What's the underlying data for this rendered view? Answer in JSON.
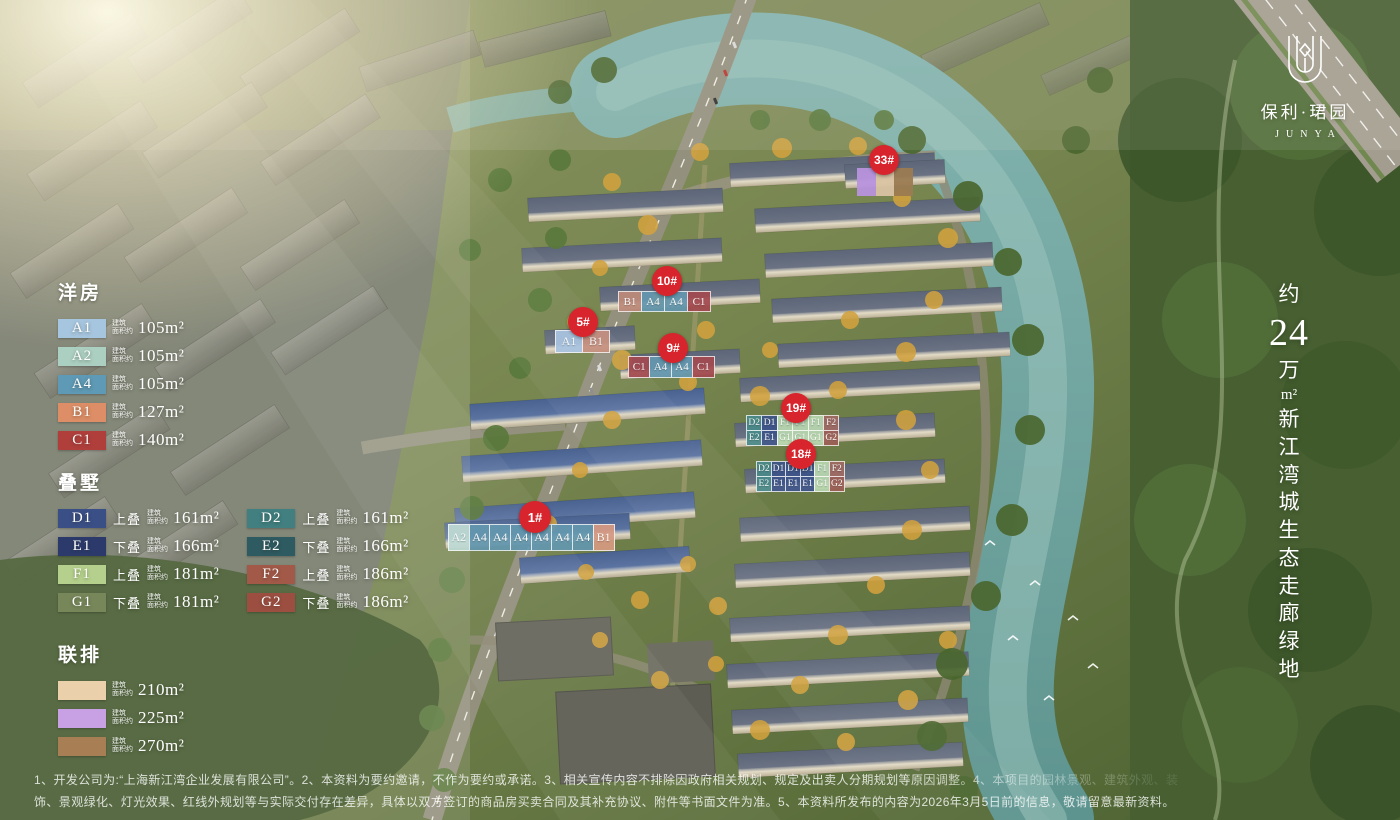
{
  "brand": {
    "name": "保利·珺园",
    "latin": "JUNYA"
  },
  "eco_tagline": {
    "about": "约",
    "number": "24",
    "wan": "万",
    "sqm": "m²",
    "chars": [
      "新",
      "江",
      "湾",
      "城",
      "生",
      "态",
      "走",
      "廊",
      "绿",
      "地"
    ]
  },
  "ui": {
    "badge_color": "#d7242d"
  },
  "legend": {
    "area_prefix": [
      "建筑",
      "面积约"
    ],
    "yangfang": {
      "title": "洋房",
      "rows": [
        {
          "code": "A1",
          "color": "#a6c5de",
          "tier": "",
          "area": "105m²"
        },
        {
          "code": "A2",
          "color": "#abcfc1",
          "tier": "",
          "area": "105m²"
        },
        {
          "code": "A4",
          "color": "#5e99b5",
          "tier": "",
          "area": "105m²"
        },
        {
          "code": "B1",
          "color": "#dd8e66",
          "tier": "",
          "area": "127m²"
        },
        {
          "code": "C1",
          "color": "#b03f3c",
          "tier": "",
          "area": "140m²"
        }
      ]
    },
    "dieshu": {
      "title": "叠墅",
      "col1": [
        {
          "code": "D1",
          "color": "#3a4f86",
          "tier": "上叠",
          "area": "161m²"
        },
        {
          "code": "E1",
          "color": "#2b3a6b",
          "tier": "下叠",
          "area": "166m²"
        },
        {
          "code": "F1",
          "color": "#b5d08c",
          "tier": "上叠",
          "area": "181m²"
        },
        {
          "code": "G1",
          "color": "#77875a",
          "tier": "下叠",
          "area": "181m²"
        }
      ],
      "col2": [
        {
          "code": "D2",
          "color": "#417f80",
          "tier": "上叠",
          "area": "161m²"
        },
        {
          "code": "E2",
          "color": "#2e5a61",
          "tier": "下叠",
          "area": "166m²"
        },
        {
          "code": "F2",
          "color": "#a25948",
          "tier": "上叠",
          "area": "186m²"
        },
        {
          "code": "G2",
          "color": "#9c4f41",
          "tier": "下叠",
          "area": "186m²"
        }
      ]
    },
    "lianpai": {
      "title": "联排",
      "rows": [
        {
          "code": "",
          "color": "#ead0ab",
          "tier": "",
          "area": "210m²"
        },
        {
          "code": "",
          "color": "#c7a1e4",
          "tier": "",
          "area": "225m²"
        },
        {
          "code": "",
          "color": "#a87e55",
          "tier": "",
          "area": "270m²"
        }
      ]
    }
  },
  "buildings": {
    "b1": {
      "no": "1#",
      "row1": [
        {
          "label": "A2",
          "color": "#bedad4"
        },
        {
          "label": "A4",
          "color": "#6397af"
        },
        {
          "label": "A4",
          "color": "#6397af"
        },
        {
          "label": "A4",
          "color": "#6397af"
        },
        {
          "label": "A4",
          "color": "#6397af"
        },
        {
          "label": "A4",
          "color": "#6397af"
        },
        {
          "label": "A4",
          "color": "#6397af"
        },
        {
          "label": "B1",
          "color": "#d69a82"
        }
      ]
    },
    "b5": {
      "no": "5#",
      "row1": [
        {
          "label": "A1",
          "color": "#a9c4e0"
        },
        {
          "label": "B1",
          "color": "#c79180"
        }
      ]
    },
    "b9": {
      "no": "9#",
      "row1": [
        {
          "label": "C1",
          "color": "#a34a50"
        },
        {
          "label": "A4",
          "color": "#6397af"
        },
        {
          "label": "A4",
          "color": "#6397af"
        },
        {
          "label": "C1",
          "color": "#a34a50"
        }
      ]
    },
    "b10": {
      "no": "10#",
      "row1": [
        {
          "label": "B1",
          "color": "#bd8a7a"
        },
        {
          "label": "A4",
          "color": "#6397af"
        },
        {
          "label": "A4",
          "color": "#6397af"
        },
        {
          "label": "C1",
          "color": "#a34a50"
        }
      ]
    },
    "b19": {
      "no": "19#",
      "row1": [
        {
          "label": "D2",
          "color": "#4a8a8a"
        },
        {
          "label": "D1",
          "color": "#3d5489"
        },
        {
          "label": "F1",
          "color": "#b7d7ae"
        },
        {
          "label": "F1",
          "color": "#b7d7ae"
        },
        {
          "label": "F1",
          "color": "#b7d7ae"
        },
        {
          "label": "F2",
          "color": "#a06a62"
        }
      ],
      "row2": [
        {
          "label": "E2",
          "color": "#4a8a8a"
        },
        {
          "label": "E1",
          "color": "#3d5489"
        },
        {
          "label": "G1",
          "color": "#b7d7ae"
        },
        {
          "label": "G1",
          "color": "#b7d7ae"
        },
        {
          "label": "G1",
          "color": "#b7d7ae"
        },
        {
          "label": "G2",
          "color": "#9c5f55"
        }
      ]
    },
    "b18": {
      "no": "18#",
      "row1": [
        {
          "label": "D2",
          "color": "#4a8a8a"
        },
        {
          "label": "D1",
          "color": "#3d5489"
        },
        {
          "label": "D1",
          "color": "#3d5489"
        },
        {
          "label": "D1",
          "color": "#3d5489"
        },
        {
          "label": "F1",
          "color": "#b7d7ae"
        },
        {
          "label": "F2",
          "color": "#a06a62"
        }
      ],
      "row2": [
        {
          "label": "E2",
          "color": "#4a8a8a"
        },
        {
          "label": "E1",
          "color": "#3d5489"
        },
        {
          "label": "E1",
          "color": "#3d5489"
        },
        {
          "label": "E1",
          "color": "#3d5489"
        },
        {
          "label": "G1",
          "color": "#b7d7ae"
        },
        {
          "label": "G2",
          "color": "#9c5f55"
        }
      ]
    },
    "b33": {
      "no": "33#",
      "row1": [
        {
          "label": "",
          "color": "#b892dd"
        },
        {
          "label": "",
          "color": "#d9c3a2"
        },
        {
          "label": "",
          "color": "#9b7b52"
        }
      ]
    }
  },
  "disclaimer": {
    "line1": "1、开发公司为:“上海新江湾企业发展有限公司”。2、本资料为要约邀请，不作为要约或承诺。3、相关宣传内容不排除因政府相关规划、规定及出卖人分期规划等原因调整。4、本项目的园林景观、建筑外观、装",
    "line2": "饰、景观绿化、灯光效果、红线外规划等与实际交付存在差异，具体以双方签订的商品房买卖合同及其补充协议、附件等书面文件为准。5、本资料所发布的内容为2026年3月5日前的信息，敬请留意最新资料。"
  }
}
